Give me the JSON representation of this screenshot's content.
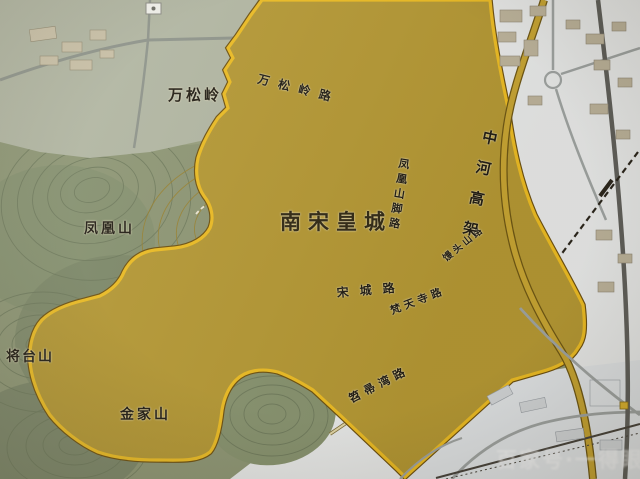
{
  "labels": {
    "zone": "南宋皇城",
    "mountains": {
      "wansongling": "万松岭",
      "fenghuangshan": "凤凰山",
      "jiangtaishan": "将台山",
      "jinjiashan": "金家山"
    },
    "roads": {
      "wansongling_road": "万松岭路",
      "fenghuangshan_jiao_road": "凤凰山脚路",
      "mantoushan_road": "馒头山路",
      "zhonghe_viaduct": "中河高架",
      "songcheng_road": "宋城路",
      "fantiansi_road": "梵天寺路",
      "tiaozhouwan_road": "笤帚湾路"
    },
    "watermark": "百家号·一得眼"
  },
  "colors": {
    "zone_hill_fill": "#b6982f",
    "zone_flat_fill": "#d0bc63",
    "zone_boundary": "#f0bd1c",
    "terrain_green": "#8d9674",
    "urban_white": "#e9ebec",
    "viaduct_yellow": "#c9a52e",
    "railway_dark": "#3f362a",
    "label_ink": "#1e1a12"
  },
  "icons": {
    "top_marker": "map-marker-icon",
    "road_marker": "road-marker-icon"
  }
}
